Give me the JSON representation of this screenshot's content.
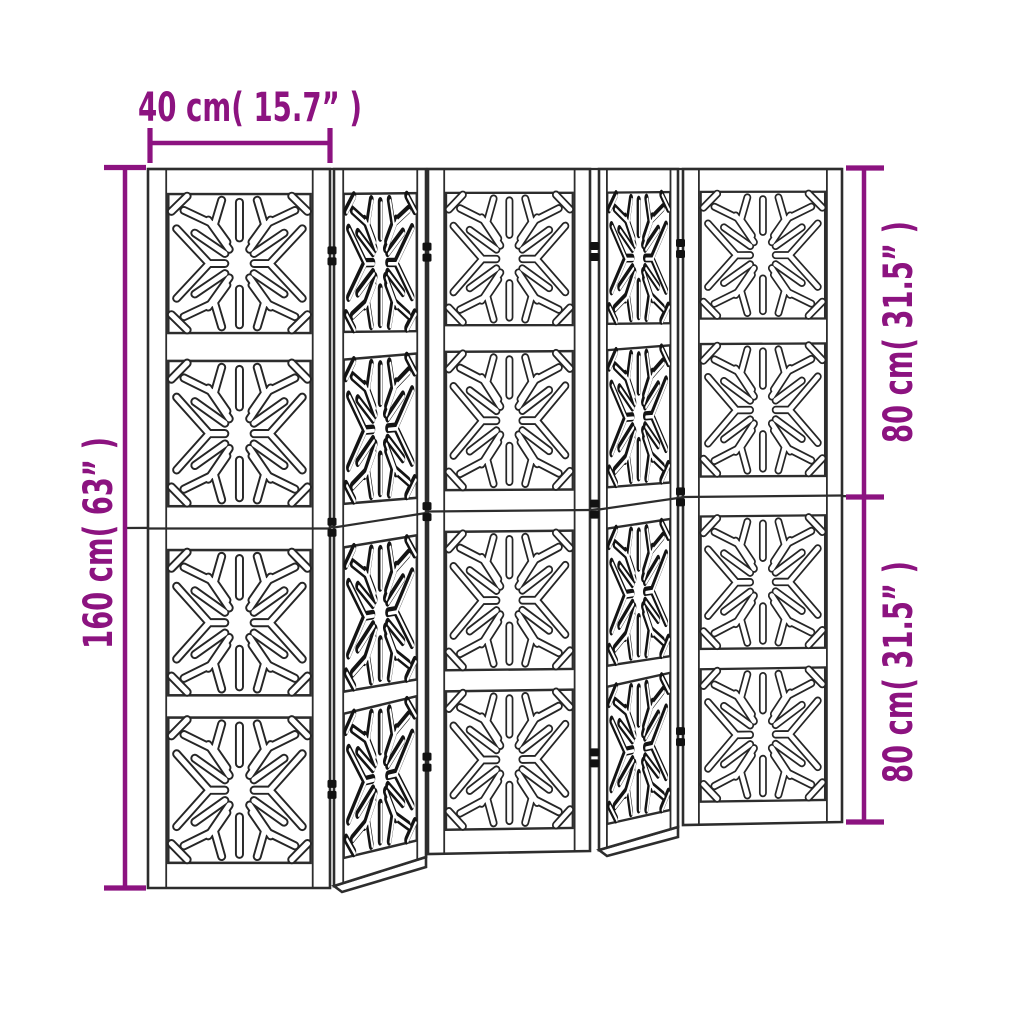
{
  "accent_color": "#8C1380",
  "line_color": "#2D2D2D",
  "dimensions": {
    "panel_width": "40 cm( 15.7” )",
    "total_height": "160 cm( 63” )",
    "upper_section_height": "80 cm( 31.5” )",
    "lower_section_height": "80 cm( 31.5” )"
  },
  "divider": {
    "panel_count": 5,
    "tiles_per_panel": 4,
    "pattern": "snowflake-cutout"
  }
}
